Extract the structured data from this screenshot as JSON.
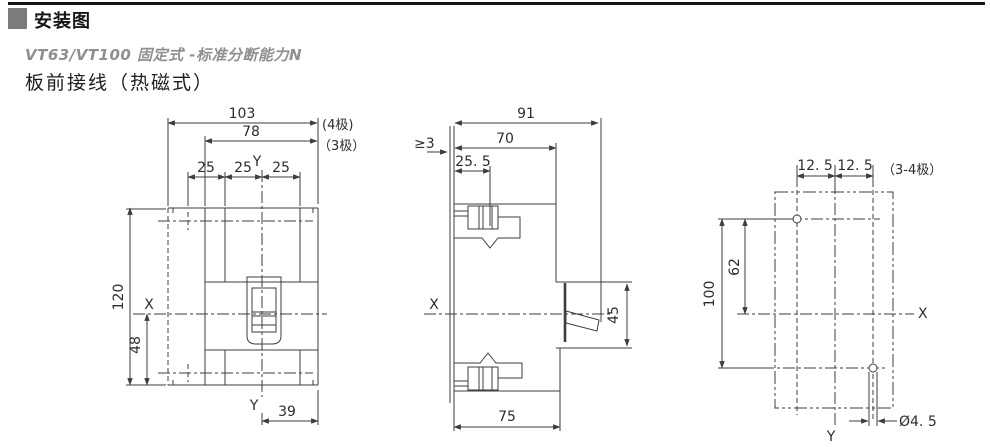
{
  "header": {
    "title": "安装图",
    "subtitle": "VT63/VT100 固定式 -标准分断能力N",
    "section": "板前接线（热磁式）"
  },
  "front_view": {
    "dim_width_4pole": "103",
    "label_4pole": "(4极)",
    "dim_width_3pole": "78",
    "label_3pole": "（3极）",
    "pole_pitch": [
      "25",
      "25",
      "25"
    ],
    "dim_height": "120",
    "dim_x_to_bottom": "48",
    "dim_y_to_edge": "39",
    "axis_x": "X",
    "axis_y_top": "Y",
    "axis_y_bottom": "Y"
  },
  "side_view": {
    "dim_total_depth": "91",
    "dim_body_depth": "70",
    "dim_terminal": "25. 5",
    "dim_panel_thickness": "≥3",
    "dim_handle_opening": "45",
    "dim_lower_depth": "75",
    "axis_x": "X"
  },
  "plan_view": {
    "label_poles": "（3-4极）",
    "dim_offset_left": "12. 5",
    "dim_offset_right": "12. 5",
    "dim_hole_v_spacing": "62",
    "dim_hole_v_span": "100",
    "dim_hole_diameter": "Ø4. 5",
    "axis_x": "X",
    "axis_y": "Y"
  }
}
